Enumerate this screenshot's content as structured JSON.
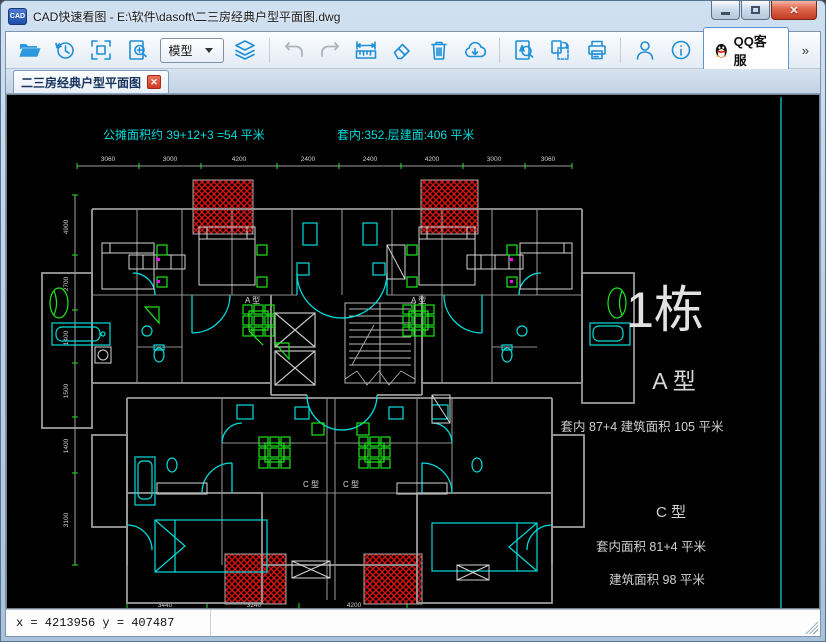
{
  "window": {
    "title": "CAD快速看图 - E:\\软件\\dasoft\\二三房经典户型平面图.dwg",
    "icon_text": "CAD"
  },
  "toolbar": {
    "model_selector": "模型",
    "qq_service": "QQ客服",
    "more": "»"
  },
  "tab": {
    "label": "二三房经典户型平面图",
    "close": "✕"
  },
  "plan": {
    "note_left": "公摊面积约 39+12+3 =54 平米",
    "note_right": "套内:352,层建面:406 平米",
    "building_no": "1栋",
    "type_a_name": "A 型",
    "type_a_area": "套内 87+4  建筑面积 105  平米",
    "type_c_name": "C 型",
    "type_c_inner": "套内面积 81+4 平米",
    "type_c_total": "建筑面积 98  平米",
    "unit_label_a": "A 型",
    "unit_label_c": "C 型",
    "dim_top": [
      "3060",
      "3000",
      "4200",
      "2400",
      "2400",
      "4200",
      "3000",
      "3060"
    ],
    "dim_bottom": [
      "3440",
      "3240",
      "4200"
    ],
    "dim_left": [
      "4900",
      "2700",
      "1400",
      "1500",
      "1400",
      "3100"
    ]
  },
  "status": {
    "coords": "x = 4213956 y = 407487"
  },
  "colors": {
    "accent_blue": "#1f8fd6",
    "cad_cyan": "#00dcdc",
    "cad_green": "#1ee61e",
    "cad_red": "#cf1212",
    "cad_gray": "#9b9b9b"
  }
}
